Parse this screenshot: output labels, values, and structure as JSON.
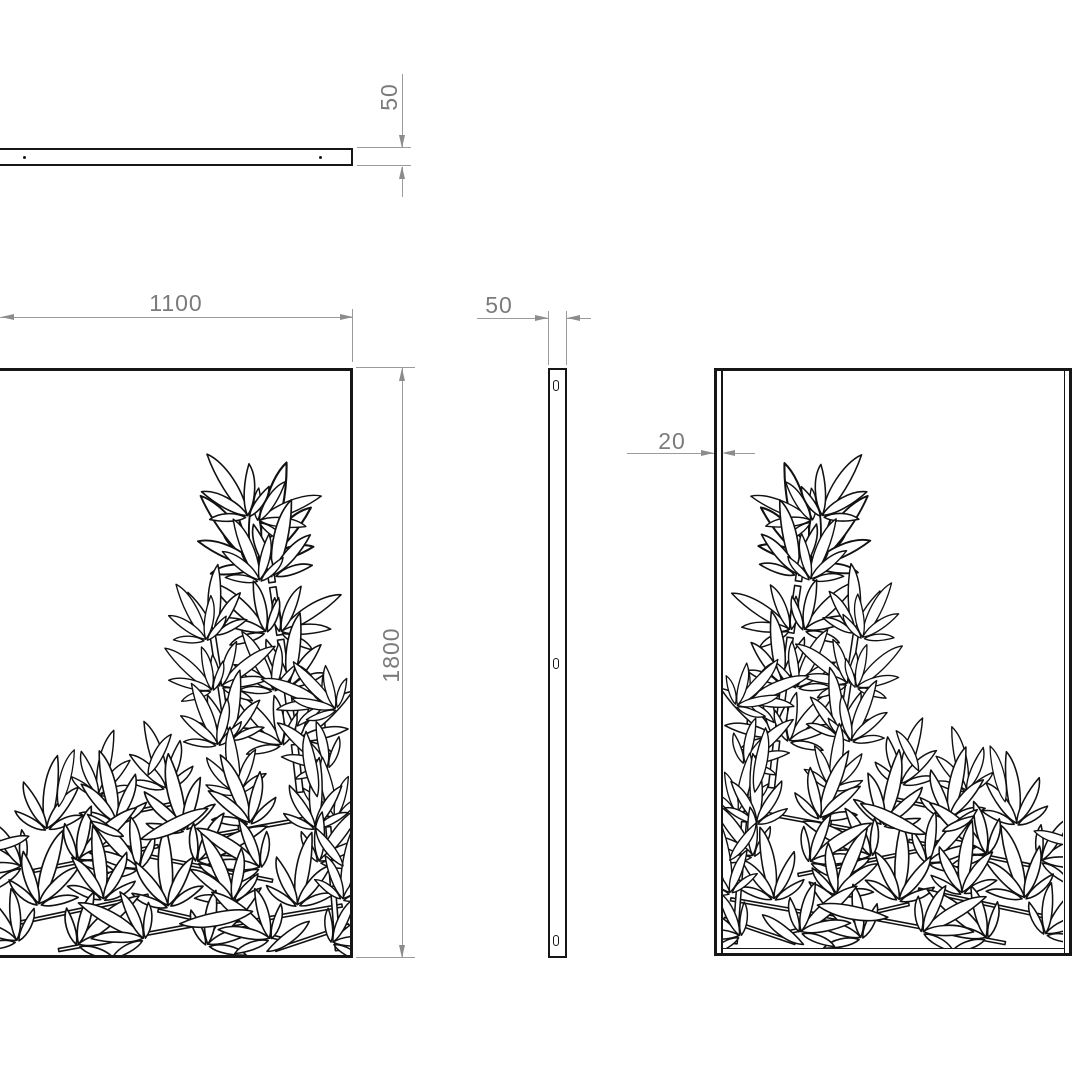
{
  "dimensions": {
    "top_thickness": "50",
    "width": "1100",
    "side_width": "50",
    "height": "1800",
    "flange": "20"
  },
  "colors": {
    "outline": "#161616",
    "dim_text": "#7b7b7b",
    "dim_line": "#9b9b9b",
    "background": "#ffffff"
  }
}
